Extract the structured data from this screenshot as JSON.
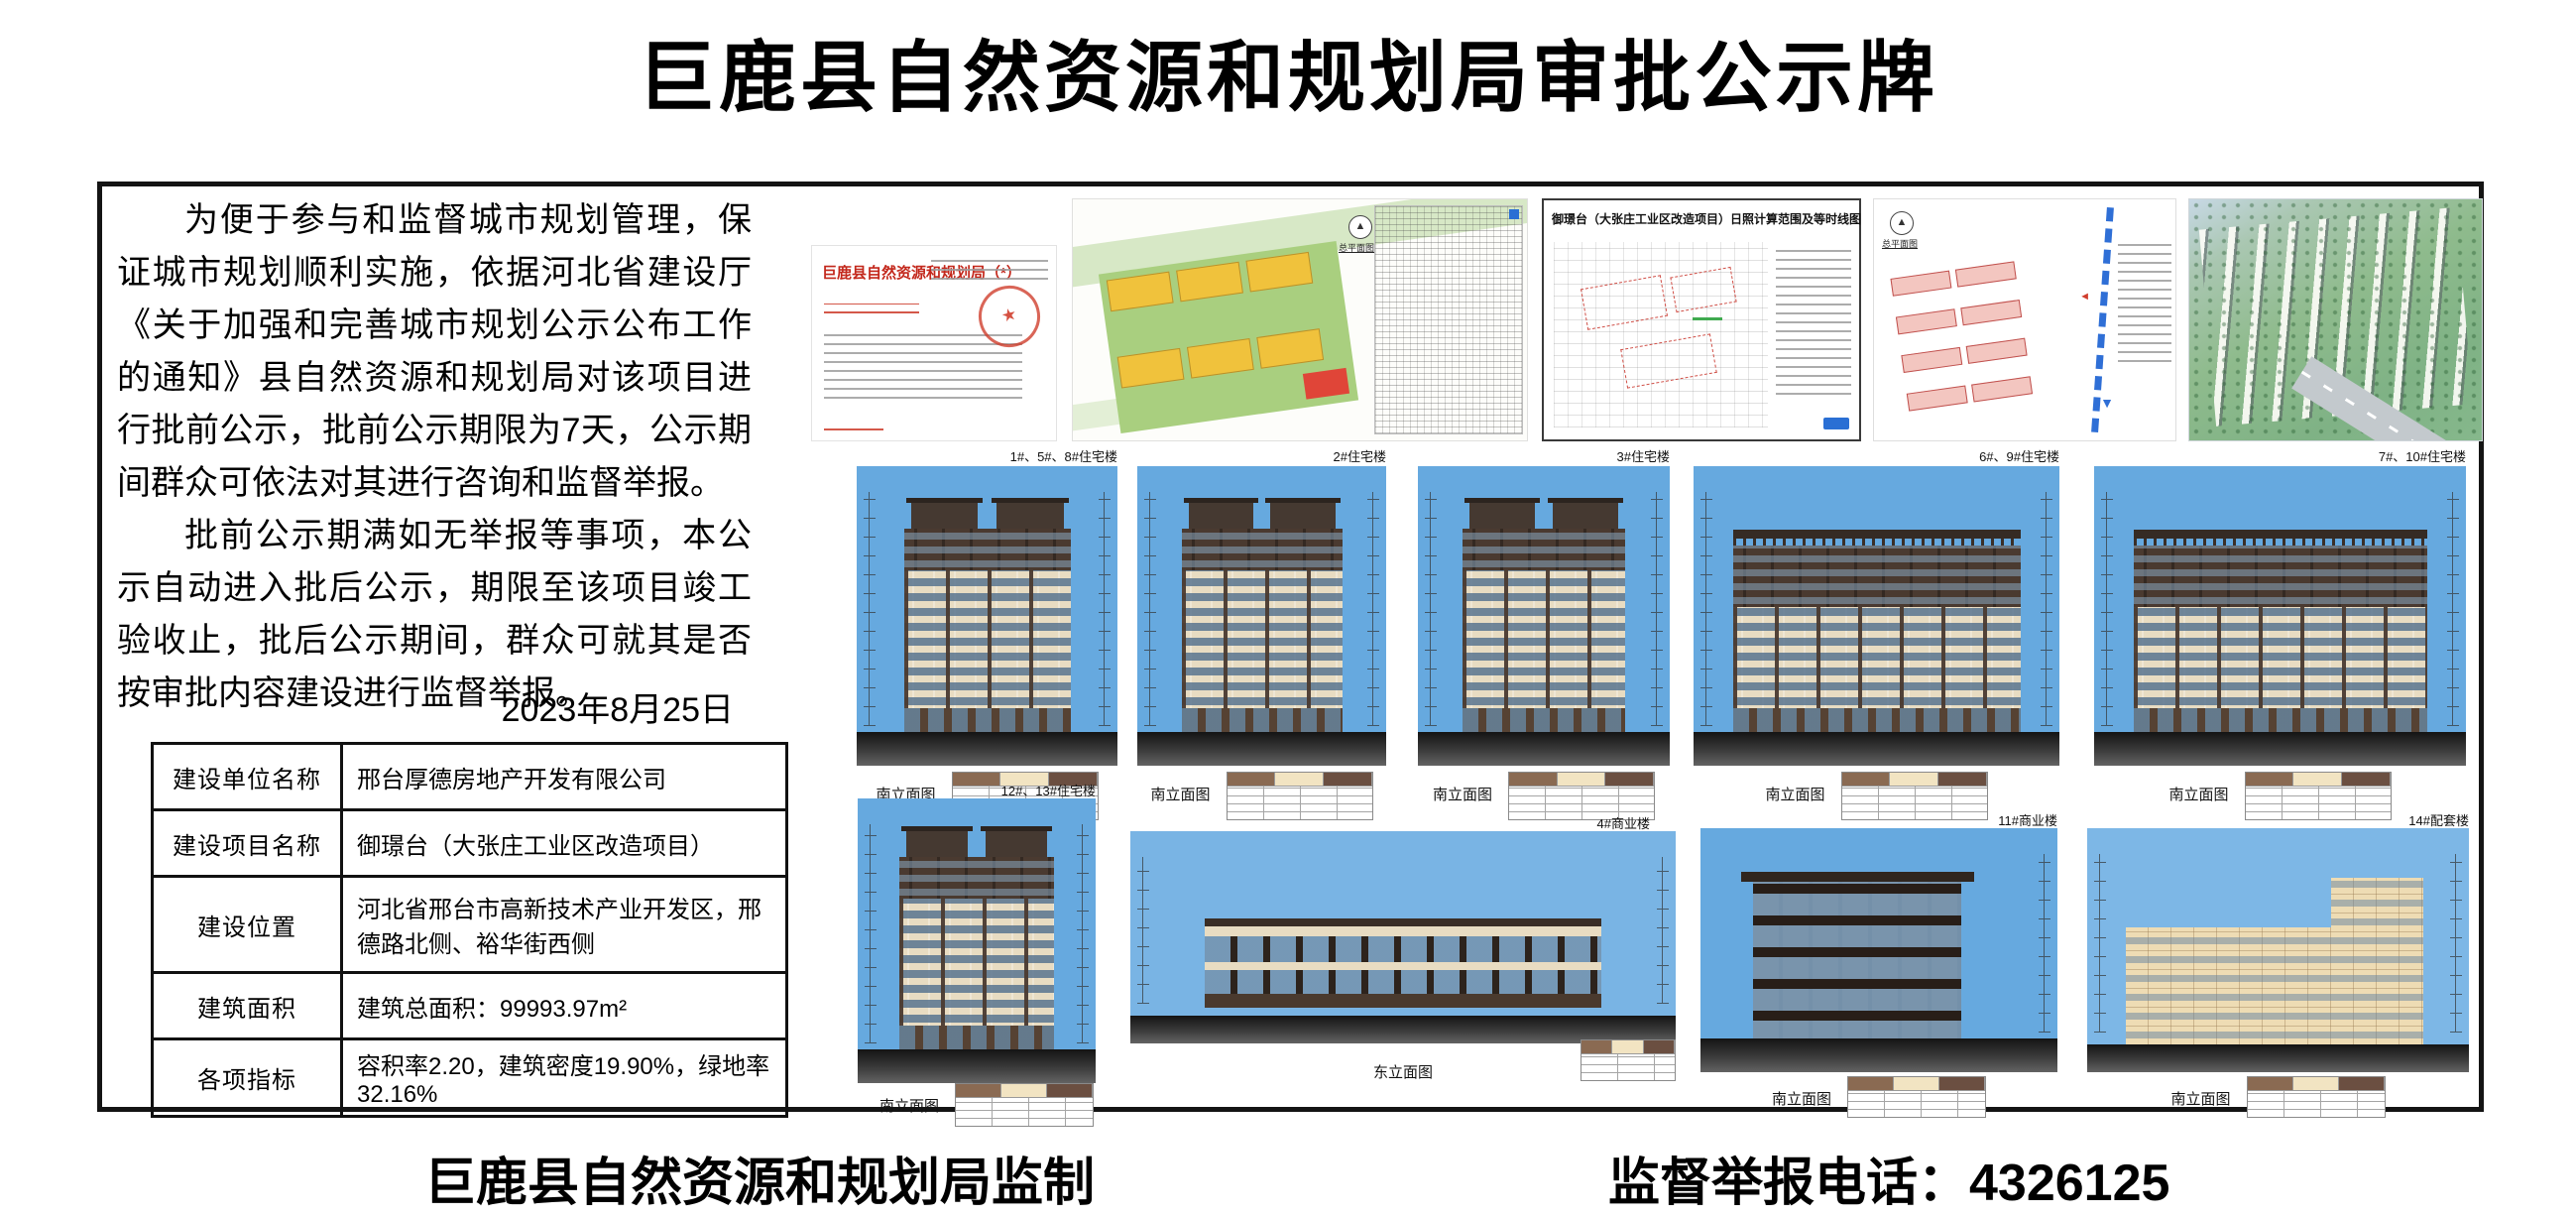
{
  "title": "巨鹿县自然资源和规划局审批公示牌",
  "notice": {
    "p1": "为便于参与和监督城市规划管理，保证城市规划顺利实施，依据河北省建设厅《关于加强和完善城市规划公示公布工作的通知》县自然资源和规划局对该项目进行批前公示，批前公示期限为7天，公示期间群众可依法对其进行咨询和监督举报。",
    "p2": "批前公示期满如无举报等事项，本公示自动进入批后公示，期限至该项目竣工验收止，批后公示期间，群众可就其是否按审批内容建设进行监督举报。",
    "date": "2023年8月25日"
  },
  "table": {
    "rows": [
      {
        "label": "建设单位名称",
        "value": "邢台厚德房地产开发有限公司"
      },
      {
        "label": "建设项目名称",
        "value": "御璟台（大张庄工业区改造项目）"
      },
      {
        "label": "建设位置",
        "value": "河北省邢台市高新技术产业开发区，邢德路北侧、裕华街西侧"
      },
      {
        "label": "建筑面积",
        "value": "建筑总面积：99993.97m²"
      },
      {
        "label": "各项指标",
        "value": "容积率2.20，建筑密度19.90%，绿地率32.16%"
      }
    ]
  },
  "panels": {
    "doc_title": "巨鹿县自然资源和规划局（*）",
    "site_plan_label": "总平面图",
    "sunshine_title": "御璟台（大张庄工业区改造项目）日照计算范围及等时线图",
    "master_plan_label": "总平面图"
  },
  "elev": [
    {
      "label": "1#、5#、8#住宅楼",
      "caption": "南立面图"
    },
    {
      "label": "2#住宅楼",
      "caption": "南立面图"
    },
    {
      "label": "3#住宅楼",
      "caption": "南立面图"
    },
    {
      "label": "6#、9#住宅楼",
      "caption": "南立面图"
    },
    {
      "label": "7#、10#住宅楼",
      "caption": "南立面图"
    },
    {
      "label": "12#、13#住宅楼",
      "caption": "南立面图"
    },
    {
      "label": "4#商业楼",
      "caption": "东立面图"
    },
    {
      "label": "11#商业楼",
      "caption": "南立面图"
    },
    {
      "label": "14#配套楼",
      "caption": "南立面图"
    }
  ],
  "footer": {
    "left": "巨鹿县自然资源和规划局监制",
    "right": "监督举报电话：4326125"
  },
  "colors": {
    "sky": "#66a9df",
    "seal_red": "#d03e2d",
    "facade_cream": "#e8dcc2",
    "facade_brown": "#4a3a30",
    "highlight_blue": "#2a6fd4",
    "plan_yellow": "#f0c23c",
    "plan_green": "#d7e8c6"
  }
}
